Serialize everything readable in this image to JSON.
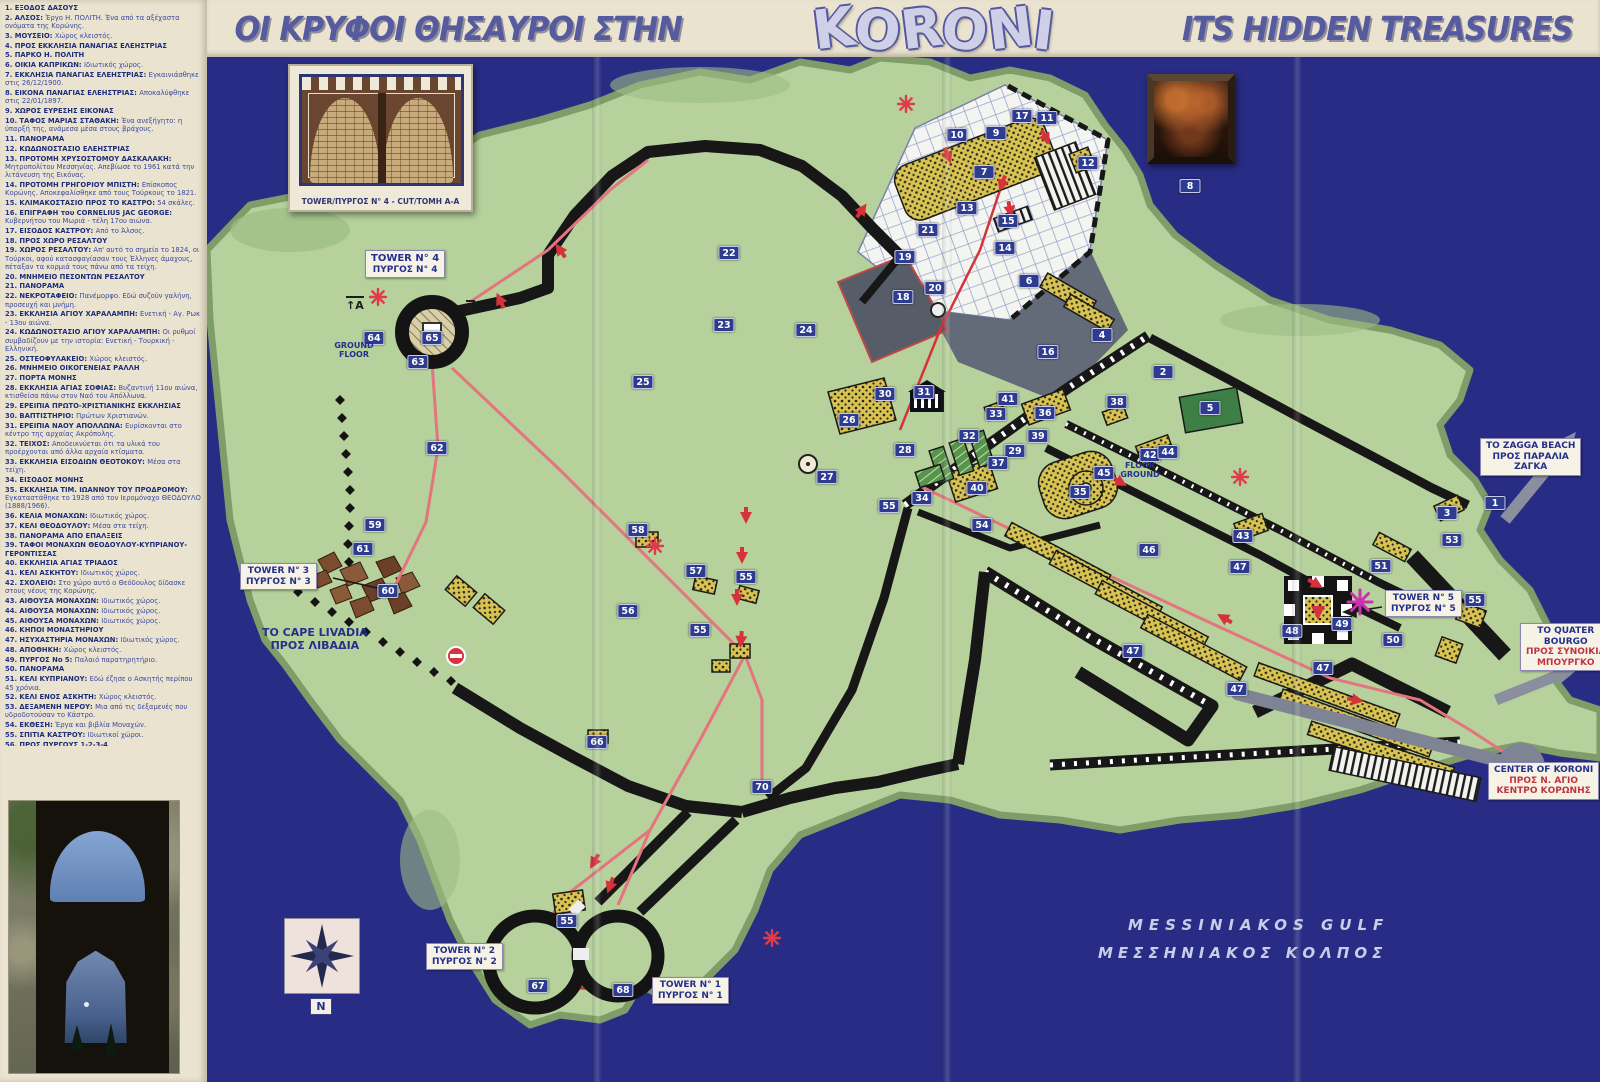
{
  "title": {
    "greek": "ΟΙ ΚΡΥΦΟΙ ΘΗΣΑΥΡΟΙ ΣΤΗΝ",
    "logo": "KORONI",
    "english": "ITS HIDDEN TREASURES"
  },
  "inset": {
    "caption": "TOWER/ΠΥΡΓΟΣ N° 4 - CUT/ΤΟΜΗ A-A"
  },
  "framed_icon": {
    "label": "8"
  },
  "compass": {
    "north": "N"
  },
  "sea": {
    "en": "MESSINIAKOS GULF",
    "gr": "ΜΕΣΣΗΝΙΑΚΟΣ ΚΟΛΠΟΣ"
  },
  "colors": {
    "sea": "#282c84",
    "land": "#b6d19c",
    "wall": "#171717",
    "marker": "#2d3c90",
    "route": "#e4747e",
    "arrow": "#d5323c",
    "building": "#d7c352",
    "cream": "#eae3d0"
  },
  "map": {
    "labels": {
      "tower4": {
        "l1": "TOWER N° 4",
        "l2": "ΠΥΡΓΟΣ N° 4"
      },
      "tower3": {
        "l1": "TOWER N° 3",
        "l2": "ΠΥΡΓΟΣ N° 3"
      },
      "tower5": {
        "l1": "TOWER N° 5",
        "l2": "ΠΥΡΓΟΣ N° 5"
      },
      "tower2": {
        "l1": "TOWER N° 2",
        "l2": "ΠΥΡΓΟΣ N° 2"
      },
      "tower1": {
        "l1": "TOWER N° 1",
        "l2": "ΠΥΡΓΟΣ N° 1"
      },
      "cape": {
        "l1": "TO CAPE LIVADIA",
        "l2": "ΠΡΟΣ ΛΙΒΑΔΙΑ"
      },
      "zagga": {
        "l1": "TO ZAGGA BEACH",
        "l2": "ΠΡΟΣ ΠΑΡΑΛΙΑ",
        "l3": "ΖΑΓΚΑ"
      },
      "bourgo": {
        "l1": "TO QUATER",
        "l2": "BOURGO",
        "l3": "ΠΡΟΣ ΣΥΝΟΙΚΙΑ",
        "l4": "ΜΠΟΥΡΓΚΟ"
      },
      "center": {
        "l1": "CENTER OF KORONI",
        "l2": "ΠΡΟΣ Ν. ΑΓΙΟ",
        "l3": "ΚΕΝΤΡΟ ΚΟΡΩΝΗΣ"
      },
      "ground_floor": "GROUND FLOOR",
      "floor_ground": "FLOOR GROUND",
      "section_a": "A"
    },
    "markers": [
      {
        "n": "1",
        "x": 1495,
        "y": 503
      },
      {
        "n": "2",
        "x": 1163,
        "y": 372
      },
      {
        "n": "3",
        "x": 1447,
        "y": 513
      },
      {
        "n": "4",
        "x": 1102,
        "y": 335
      },
      {
        "n": "5",
        "x": 1210,
        "y": 408
      },
      {
        "n": "6",
        "x": 1029,
        "y": 281
      },
      {
        "n": "7",
        "x": 984,
        "y": 172
      },
      {
        "n": "8",
        "x": 1190,
        "y": 186
      },
      {
        "n": "9",
        "x": 996,
        "y": 133
      },
      {
        "n": "10",
        "x": 957,
        "y": 135
      },
      {
        "n": "11",
        "x": 1047,
        "y": 118
      },
      {
        "n": "12",
        "x": 1088,
        "y": 163
      },
      {
        "n": "13",
        "x": 967,
        "y": 208
      },
      {
        "n": "14",
        "x": 1005,
        "y": 248
      },
      {
        "n": "15",
        "x": 1008,
        "y": 221
      },
      {
        "n": "16",
        "x": 1048,
        "y": 352
      },
      {
        "n": "17",
        "x": 1022,
        "y": 116
      },
      {
        "n": "18",
        "x": 903,
        "y": 297
      },
      {
        "n": "19",
        "x": 905,
        "y": 257
      },
      {
        "n": "20",
        "x": 935,
        "y": 288
      },
      {
        "n": "21",
        "x": 928,
        "y": 230
      },
      {
        "n": "22",
        "x": 729,
        "y": 253
      },
      {
        "n": "23",
        "x": 724,
        "y": 325
      },
      {
        "n": "24",
        "x": 806,
        "y": 330
      },
      {
        "n": "25",
        "x": 643,
        "y": 382
      },
      {
        "n": "26",
        "x": 849,
        "y": 420
      },
      {
        "n": "27",
        "x": 827,
        "y": 477
      },
      {
        "n": "28",
        "x": 905,
        "y": 450
      },
      {
        "n": "29",
        "x": 1015,
        "y": 451
      },
      {
        "n": "30",
        "x": 885,
        "y": 394
      },
      {
        "n": "31",
        "x": 924,
        "y": 392
      },
      {
        "n": "32",
        "x": 969,
        "y": 436
      },
      {
        "n": "33",
        "x": 996,
        "y": 414
      },
      {
        "n": "34",
        "x": 922,
        "y": 498
      },
      {
        "n": "35",
        "x": 1080,
        "y": 492
      },
      {
        "n": "36",
        "x": 1045,
        "y": 413
      },
      {
        "n": "37",
        "x": 998,
        "y": 463
      },
      {
        "n": "38",
        "x": 1117,
        "y": 402
      },
      {
        "n": "39",
        "x": 1038,
        "y": 436
      },
      {
        "n": "40",
        "x": 977,
        "y": 488
      },
      {
        "n": "41",
        "x": 1008,
        "y": 399
      },
      {
        "n": "42",
        "x": 1150,
        "y": 455
      },
      {
        "n": "43",
        "x": 1243,
        "y": 536
      },
      {
        "n": "44",
        "x": 1168,
        "y": 452
      },
      {
        "n": "45",
        "x": 1104,
        "y": 473
      },
      {
        "n": "46",
        "x": 1149,
        "y": 550
      },
      {
        "n": "47",
        "x": 1240,
        "y": 567
      },
      {
        "n": "47",
        "x": 1133,
        "y": 651
      },
      {
        "n": "47",
        "x": 1237,
        "y": 689
      },
      {
        "n": "47",
        "x": 1323,
        "y": 668
      },
      {
        "n": "48",
        "x": 1292,
        "y": 631
      },
      {
        "n": "49",
        "x": 1342,
        "y": 624
      },
      {
        "n": "50",
        "x": 1393,
        "y": 640
      },
      {
        "n": "51",
        "x": 1381,
        "y": 566
      },
      {
        "n": "52",
        "x": 1428,
        "y": 598
      },
      {
        "n": "53",
        "x": 1452,
        "y": 540
      },
      {
        "n": "54",
        "x": 982,
        "y": 525
      },
      {
        "n": "55",
        "x": 889,
        "y": 506
      },
      {
        "n": "55",
        "x": 746,
        "y": 577
      },
      {
        "n": "55",
        "x": 1475,
        "y": 600
      },
      {
        "n": "55",
        "x": 567,
        "y": 921
      },
      {
        "n": "55",
        "x": 700,
        "y": 630
      },
      {
        "n": "56",
        "x": 628,
        "y": 611
      },
      {
        "n": "57",
        "x": 696,
        "y": 571
      },
      {
        "n": "58",
        "x": 638,
        "y": 530
      },
      {
        "n": "59",
        "x": 375,
        "y": 525
      },
      {
        "n": "60",
        "x": 388,
        "y": 591
      },
      {
        "n": "61",
        "x": 363,
        "y": 549
      },
      {
        "n": "62",
        "x": 437,
        "y": 448
      },
      {
        "n": "63",
        "x": 418,
        "y": 362
      },
      {
        "n": "64",
        "x": 374,
        "y": 338
      },
      {
        "n": "65",
        "x": 432,
        "y": 338
      },
      {
        "n": "66",
        "x": 597,
        "y": 742
      },
      {
        "n": "67",
        "x": 538,
        "y": 986
      },
      {
        "n": "68",
        "x": 623,
        "y": 990
      },
      {
        "n": "69",
        "x": 679,
        "y": 986
      },
      {
        "n": "70",
        "x": 762,
        "y": 787
      }
    ]
  },
  "legend": {
    "items": [
      {
        "n": 1,
        "t": "ΕΞΟΔΟΣ ΔΑΣΟΥΣ",
        "d": ""
      },
      {
        "n": 2,
        "t": "ΑΛΣΟΣ",
        "d": "Έργο Η. ΠΟΛΙΤΗ. Ένα από τα αξέχαστα ονόματα της Κορώνης."
      },
      {
        "n": 3,
        "t": "ΜΟΥΣΕΙΟ",
        "d": "Χώρος κλειστός."
      },
      {
        "n": 4,
        "t": "ΠΡΟΣ ΕΚΚΛΗΣΙΑ ΠΑΝΑΓΙΑΣ ΕΛΕΗΣΤΡΙΑΣ",
        "d": ""
      },
      {
        "n": 5,
        "t": "ΠΑΡΚΟ Η. ΠΟΛΙΤΗ",
        "d": ""
      },
      {
        "n": 6,
        "t": "ΟΙΚΙΑ ΚΑΠΡΙΚΩΝ",
        "d": "Ιδιωτικός χώρος."
      },
      {
        "n": 7,
        "t": "ΕΚΚΛΗΣΙΑ ΠΑΝΑΓΙΑΣ ΕΛΕΗΣΤΡΙΑΣ",
        "d": "Εγκαινιάσθηκε στις 26/12/1900."
      },
      {
        "n": 8,
        "t": "ΕΙΚΟΝΑ ΠΑΝΑΓΙΑΣ ΕΛΕΗΣΤΡΙΑΣ",
        "d": "Αποκαλύφθηκε στις 22/01/1897."
      },
      {
        "n": 9,
        "t": "ΧΩΡΟΣ ΕΥΡΕΣΗΣ ΕΙΚΟΝΑΣ",
        "d": ""
      },
      {
        "n": 10,
        "t": "ΤΑΦΟΣ ΜΑΡΙΑΣ ΣΤΑΘΑΚΗ",
        "d": "Ένα ανεξήγητο: η ύπαρξή της, ανάμεσα μέσα στους βράχους."
      },
      {
        "n": 11,
        "t": "ΠΑΝΟΡΑΜΑ",
        "d": ""
      },
      {
        "n": 12,
        "t": "ΚΩΔΩΝΟΣΤΑΣΙΟ ΕΛΕΗΣΤΡΙΑΣ",
        "d": ""
      },
      {
        "n": 13,
        "t": "ΠΡΟΤΟΜΗ ΧΡΥΣΟΣΤΟΜΟΥ ΔΑΣΚΑΛΑΚΗ",
        "d": "Μητροπολίτου Μεσσηνίας. Απεβίωσε το 1961 κατά την λιτάνευση της Εικόνας."
      },
      {
        "n": 14,
        "t": "ΠΡΟΤΟΜΗ ΓΡΗΓΟΡΙΟΥ ΜΠΙΣΤΗ",
        "d": "Επίσκοπος Κορώνης. Αποκεφαλίσθηκε από τους Τούρκους το 1821."
      },
      {
        "n": 15,
        "t": "ΚΛΙΜΑΚΟΣΤΑΣΙΟ ΠΡΟΣ ΤΟ ΚΑΣΤΡΟ",
        "d": "54 σκάλες."
      },
      {
        "n": 16,
        "t": "ΕΠΙΓΡΑΦΗ του CORNELIUS JAC GEORGE",
        "d": "Κυβερνήτου του Μωριά - τέλη 17ου αιώνα."
      },
      {
        "n": 17,
        "t": "ΕΙΣΟΔΟΣ ΚΑΣΤΡΟΥ",
        "d": "Από το Άλσος."
      },
      {
        "n": 18,
        "t": "ΠΡΟΣ ΧΩΡΟ ΡΕΣΑΛΤΟΥ",
        "d": ""
      },
      {
        "n": 19,
        "t": "ΧΩΡΟΣ ΡΕΣΑΛΤΟΥ",
        "d": "Απ' αυτό το σημείο το 1824, οι Τούρκοι, αφού κατασφαγίασαν τους Έλληνες άμαχους, πέταξαν τα κορμιά τους πάνω από τα τείχη."
      },
      {
        "n": 20,
        "t": "ΜΝΗΜΕΙΟ ΠΕΣΟΝΤΩΝ ΡΕΣΑΛΤΟΥ",
        "d": ""
      },
      {
        "n": 21,
        "t": "ΠΑΝΟΡΑΜΑ",
        "d": ""
      },
      {
        "n": 22,
        "t": "ΝΕΚΡΟΤΑΦΕΙΟ",
        "d": "Πανέμορφο. Εδώ συζούν γαλήνη, προσευχή και μνήμη."
      },
      {
        "n": 23,
        "t": "ΕΚΚΛΗΣΙΑ ΑΓΙΟΥ ΧΑΡΑΛΑΜΠΗ",
        "d": "Ενετική - Αγ. Ρωκ - 13ου αιώνα."
      },
      {
        "n": 24,
        "t": "ΚΩΔΩΝΟΣΤΑΣΙΟ ΑΓΙΟΥ ΧΑΡΑΛΑΜΠΗ",
        "d": "Οι ρυθμοί συμβαδίζουν με την ιστορία: Ενετική - Τουρκική - Ελληνική."
      },
      {
        "n": 25,
        "t": "ΟΣΤΕΟΦΥΛΑΚΕΙΟ",
        "d": "Χώρος κλειστός."
      },
      {
        "n": 26,
        "t": "ΜΝΗΜΕΙΟ ΟΙΚΟΓΕΝΕΙΑΣ ΡΑΛΛΗ",
        "d": ""
      },
      {
        "n": 27,
        "t": "ΠΟΡΤΑ ΜΟΝΗΣ",
        "d": ""
      },
      {
        "n": 28,
        "t": "ΕΚΚΛΗΣΙΑ ΑΓΙΑΣ ΣΟΦΙΑΣ",
        "d": "Βυζαντινή 11ου αιώνα, κτισθείσα πάνω στον Ναό του Απόλλωνα."
      },
      {
        "n": 29,
        "t": "ΕΡΕΙΠΙΑ ΠΡΩΤΟ-ΧΡΙΣΤΙΑΝΙΚΗΣ ΕΚΚΛΗΣΙΑΣ",
        "d": ""
      },
      {
        "n": 30,
        "t": "ΒΑΠΤΙΣΤΗΡΙΟ",
        "d": "Πρώτων Χριστιανών."
      },
      {
        "n": 31,
        "t": "ΕΡΕΙΠΙΑ ΝΑΟΥ ΑΠΟΛΛΩΝΑ",
        "d": "Ευρίσκονται στο κέντρο της αρχαίας Ακρόπολης."
      },
      {
        "n": 32,
        "t": "ΤΕΙΧΟΣ",
        "d": "Αποδεικνύεται ότι τα υλικά του προέρχονται από άλλα αρχαία κτίσματα."
      },
      {
        "n": 33,
        "t": "ΕΚΚΛΗΣΙΑ ΕΙΣΟΔΙΩΝ ΘΕΟΤΟΚΟΥ",
        "d": "Μέσα στα τείχη."
      },
      {
        "n": 34,
        "t": "ΕΙΣΟΔΟΣ ΜΟΝΗΣ",
        "d": ""
      },
      {
        "n": 35,
        "t": "ΕΚΚΛΗΣΙΑ ΤΙΜ. ΙΩΑΝΝΟΥ ΤΟΥ ΠΡΟΔΡΟΜΟΥ",
        "d": "Εγκαταστάθηκε το 1928 από τον Ιερομόναχο ΘΕΟΔΟΥΛΟ (1888/1966)."
      },
      {
        "n": 36,
        "t": "ΚΕΛΙΑ ΜΟΝΑΧΩΝ",
        "d": "Ιδιωτικός χώρος."
      },
      {
        "n": 37,
        "t": "ΚΕΛΙ ΘΕΟΔΟΥΛΟΥ",
        "d": "Μέσα στα τείχη."
      },
      {
        "n": 38,
        "t": "ΠΑΝΟΡΑΜΑ ΑΠΟ ΕΠΑΛΞΕΙΣ",
        "d": ""
      },
      {
        "n": 39,
        "t": "ΤΑΦΟΙ ΜΟΝΑΧΩΝ ΘΕΟΔΟΥΛΟΥ-ΚΥΠΡΙΑΝΟΥ-ΓΕΡΟΝΤΙΣΣΑΣ",
        "d": ""
      },
      {
        "n": 40,
        "t": "ΕΚΚΛΗΣΙΑ ΑΓΙΑΣ ΤΡΙΑΔΟΣ",
        "d": ""
      },
      {
        "n": 41,
        "t": "ΚΕΛΙ ΑΣΚΗΤΟΥ",
        "d": "Ιδιωτικός χώρος."
      },
      {
        "n": 42,
        "t": "ΣΧΟΛΕΙΟ",
        "d": "Στο χώρο αυτό ο Θεόδουλος δίδασκε στους νέους της Κορώνης."
      },
      {
        "n": 43,
        "t": "ΑΙΘΟΥΣΑ ΜΟΝΑΧΩΝ",
        "d": "Ιδιωτικός χώρος."
      },
      {
        "n": 44,
        "t": "ΑΙΘΟΥΣΑ ΜΟΝΑΧΩΝ",
        "d": "Ιδιωτικός χώρος."
      },
      {
        "n": 45,
        "t": "ΑΙΘΟΥΣΑ ΜΟΝΑΧΩΝ",
        "d": "Ιδιωτικός χώρος."
      },
      {
        "n": 46,
        "t": "ΚΗΠΟΙ ΜΟΝΑΣΤΗΡΙΟΥ",
        "d": ""
      },
      {
        "n": 47,
        "t": "ΗΣΥΧΑΣΤΗΡΙΑ ΜΟΝΑΧΩΝ",
        "d": "Ιδιωτικός χώρος."
      },
      {
        "n": 48,
        "t": "ΑΠΟΘΗΚΗ",
        "d": "Χώρος κλειστός."
      },
      {
        "n": 49,
        "t": "ΠΥΡΓΟΣ Νο 5",
        "d": "Παλαιό παρατηρητήριο."
      },
      {
        "n": 50,
        "t": "ΠΑΝΟΡΑΜΑ",
        "d": ""
      },
      {
        "n": 51,
        "t": "ΚΕΛΙ ΚΥΠΡΙΑΝΟΥ",
        "d": "Εδώ έζησε ο Ασκητής περίπου 45 χρόνια."
      },
      {
        "n": 52,
        "t": "ΚΕΛΙ ΕΝΟΣ ΑΣΚΗΤΗ",
        "d": "Χώρος κλειστός."
      },
      {
        "n": 53,
        "t": "ΔΕΞΑΜΕΝΗ ΝΕΡΟΥ",
        "d": "Μια από τις δεξαμενές που υδροδοτούσαν το Κάστρο."
      },
      {
        "n": 54,
        "t": "ΕΚΘΕΣΗ",
        "d": "Έργα και βιβλία Μοναχών."
      },
      {
        "n": 55,
        "t": "ΣΠΙΤΙΑ ΚΑΣΤΡΟΥ",
        "d": "Ιδιωτικοί χώροι."
      },
      {
        "n": 56,
        "t": "ΠΡΟΣ ΠΥΡΓΟΥΣ 1-2-3-4",
        "d": ""
      },
      {
        "n": 57,
        "t": "ΣΠΙΤΙ",
        "d": "Εντοιχισμένα υλικά από αρχαία κτίσματα."
      },
      {
        "n": 58,
        "t": "ΤΟΥΡΚΙΚΑ ΛΟΥΤΡΑ",
        "d": "Δεν επισκέπτονται."
      },
      {
        "n": 59,
        "t": "ΠΡΟΣ ΦΥΛΑΚΕΣ",
        "d": ""
      },
      {
        "n": 60,
        "t": "ΦΥΛΑΚΕΣ",
        "d": "Ενετικές και Τουρκικές."
      },
      {
        "n": 61,
        "t": "ΕΡΕΙΠΙΑ ΠΥΡΓΟΥ Νο 3",
        "d": "Βομβαρδίστηκε κατά το Β' Παγκόσμιο Πόλεμο."
      },
      {
        "n": 62,
        "t": "ΠΡΟΣ ΠΥΡΓΟ Νο 4",
        "d": ""
      },
      {
        "n": 63,
        "t": "ΕΙΣΟΔΟΣ ΠΥΡΓΟΥ Νο 4",
        "d": "Υπήρχε η θέση που ήταν τοποθετημένος ο Λέων του Αγίου Μάρκου."
      },
      {
        "n": 64,
        "t": "ΙΣΟΓΕΙΟ ΠΥΡΓΟΥ Νο 4",
        "d": "Φανταστική αίθουσα με εσωτερικό κενό 12 μέτρων."
      },
      {
        "n": 65,
        "t": "ΤΑΡΑΤΣΑ ΠΥΡΓΟΥ Νο 4",
        "d": "Παραβολικά - παλαιό εκκλησάκι."
      },
      {
        "n": 66,
        "t": "ΠΡΟΣ ΠΥΡΓΟΥΣ 1-2",
        "d": ""
      },
      {
        "n": 67,
        "t": "ΠΥΡΓΟΣ Νο 2",
        "d": ""
      },
      {
        "n": 68,
        "t": "ΠΥΡΓΟΣ Νο 1",
        "d": ""
      },
      {
        "n": 69,
        "t": "ΠΑΝΟΡΑΜΑ",
        "d": ""
      },
      {
        "n": 70,
        "t": "ΚΕΝΤΡΙΚΗ ΠΟΡΤΑ ΚΑΣΤΡΟΥ",
        "d": "Κτίσμα «Ενετικής Τέχνης»."
      }
    ]
  }
}
